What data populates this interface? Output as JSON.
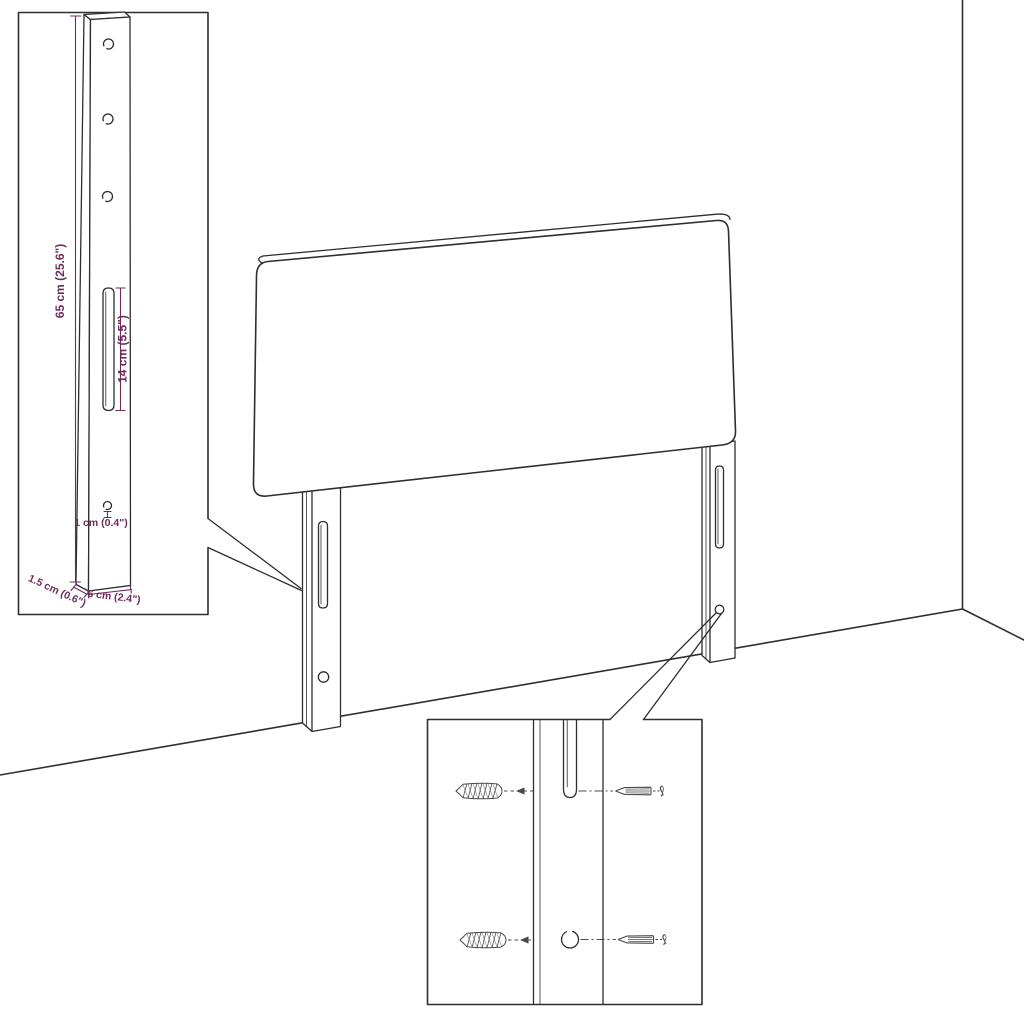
{
  "colors": {
    "bg": "#ffffff",
    "line": "#2e2e2e",
    "annotation": "#6e2c5c"
  },
  "diagram": {
    "type": "furniture-assembly-technical-drawing",
    "subject": "upholstered headboard with two mounting legs, wall corner backdrop, leg-dimension inset and wall-fixing (anchor + screw) inset",
    "dimension_labels": {
      "height": "65 cm (25.6\")",
      "slot": "14 cm (5.5\")",
      "hole": "1 cm (0.4\")",
      "depth": "1.5 cm (0.6\")",
      "width": "6 cm (2.4\")"
    }
  }
}
